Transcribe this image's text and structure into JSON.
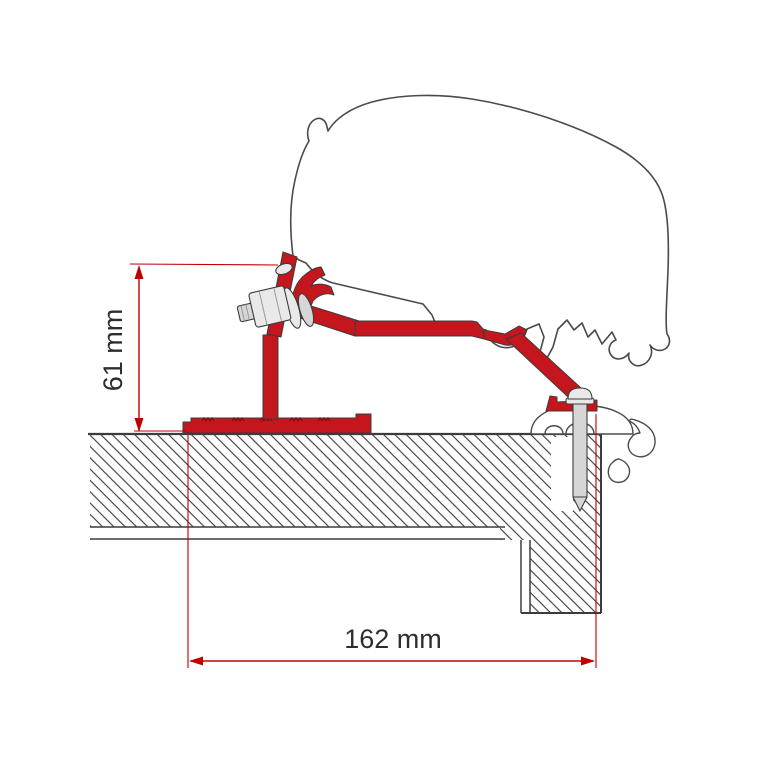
{
  "diagram": {
    "type": "technical-cross-section",
    "subject": "Awning adapter bracket mounted on caravan roof - side cross-section",
    "dimensions": {
      "height": {
        "label": "61 mm",
        "value": 61,
        "unit": "mm",
        "orientation": "vertical"
      },
      "width": {
        "label": "162 mm",
        "value": 162,
        "unit": "mm",
        "orientation": "horizontal"
      }
    },
    "colors": {
      "background": "#ffffff",
      "bracket_red": "#c4161c",
      "bracket_red_dark": "#8a0d12",
      "dimension_red": "#c00000",
      "profile_outline": "#4a4a4a",
      "part_edge": "#3c3c3c",
      "section_line": "#3c3c3c",
      "metal_light": "#e9e9e9",
      "metal_mid": "#d6d6d6",
      "label_text": "#2e2e2e"
    },
    "parts": [
      {
        "name": "awning-case-profile",
        "style": "gray outline, white fill"
      },
      {
        "name": "adapter-bracket",
        "style": "red filled profile with serrated base"
      },
      {
        "name": "hex-bolt-with-washers",
        "style": "light gray metal"
      },
      {
        "name": "roof-fixing-screw",
        "style": "light gray metal, pointed tip"
      },
      {
        "name": "roof-rail-trim-profile",
        "style": "gray outline, white fill"
      },
      {
        "name": "roof-cross-section",
        "style": "diagonal hatching"
      },
      {
        "name": "wall-cross-section",
        "style": "diagonal hatching"
      }
    ]
  }
}
